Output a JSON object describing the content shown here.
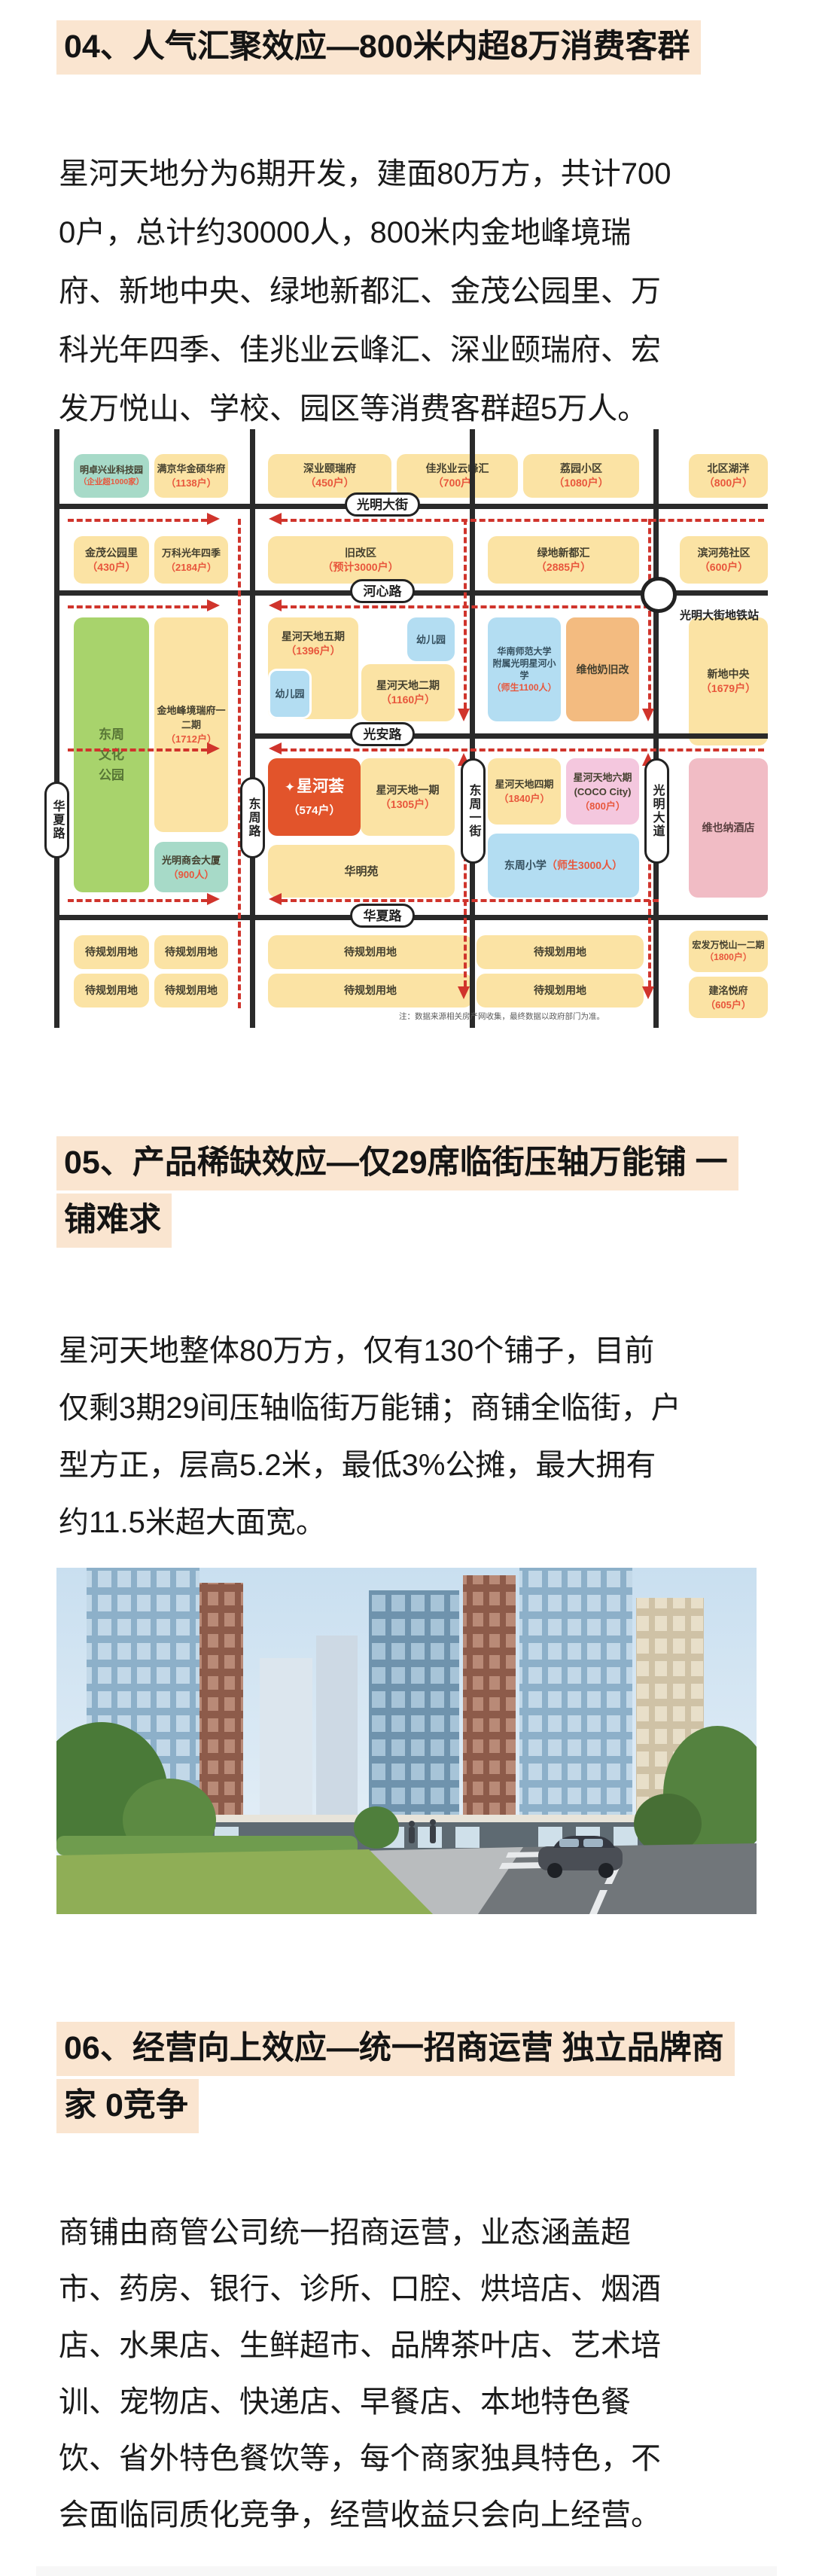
{
  "s04": {
    "heading": "04、人气汇聚效应—800米内超8万消费客群",
    "para": [
      "星河天地分为6期开发，建面80万方，共计700",
      "0户，总计约30000人，800米内金地峰境瑞",
      "府、新地中央、绿地新都汇、金茂公园里、万",
      "科光年四季、佳兆业云峰汇、深业颐瑞府、宏",
      "发万悦山、学校、园区等消费客群超5万人。"
    ]
  },
  "s05": {
    "heading_lines": [
      "05、产品稀缺效应—仅29席临街压轴万能铺 一",
      "铺难求"
    ],
    "para": [
      "星河天地整体80万方，仅有130个铺子，目前",
      "仅剩3期29间压轴临街万能铺；商铺全临街，户",
      "型方正，层高5.2米，最低3%公摊，最大拥有",
      "约11.5米超大面宽。"
    ]
  },
  "s06": {
    "heading_lines": [
      "06、经营向上效应—统一招商运营 独立品牌商",
      "家 0竞争"
    ],
    "para": [
      "商铺由商管公司统一招商运营，业态涵盖超",
      "市、药房、银行、诊所、口腔、烘培店、烟酒",
      "店、水果店、生鲜超市、品牌茶叶店、艺术培",
      "训、宠物店、快递店、早餐店、本地特色餐",
      "饮、省外特色餐饮等，每个商家独具特色，不",
      "会面临同质化竞争，经营收益只会向上经营。"
    ]
  },
  "map": {
    "roads": {
      "guangming_street": "光明大街",
      "hexin_road": "河心路",
      "guangan_road": "光安路",
      "huaxia_road_h": "华夏路",
      "huaxia_road_v": "华夏路",
      "dongzhou_road": "东周路",
      "dongzhou_first_street": "东周一街",
      "guangming_avenue": "光明大道"
    },
    "metro_station": "光明大街地铁站",
    "note": "注：数据来源相关房产网收集，最终数据以政府部门为准。",
    "logo_star": "✦",
    "blocks": {
      "mingzhuo": {
        "name": "明卓兴业科技园",
        "num": "（企业超1000家）"
      },
      "manjinghua": {
        "name": "满京华金硕华府",
        "num": "（1138户）"
      },
      "shenye": {
        "name": "深业颐瑞府",
        "num": "（450户）"
      },
      "jiazhaoye": {
        "name": "佳兆业云峰汇",
        "num": "（700户）"
      },
      "liyuan": {
        "name": "荔园小区",
        "num": "（1080户）"
      },
      "beiqu": {
        "name": "北区湖泮",
        "num": "（800户）"
      },
      "jinmao": {
        "name": "金茂公园里",
        "num": "（430户）"
      },
      "vanke": {
        "name": "万科光年四季",
        "num": "（2184户）"
      },
      "jiugai": {
        "name": "旧改区",
        "num": "（预计3000户）"
      },
      "lvdi": {
        "name": "绿地新都汇",
        "num": "（2885户）"
      },
      "binheyuan": {
        "name": "滨河苑社区",
        "num": "（600户）"
      },
      "park": {
        "l1": "东周",
        "l2": "文化",
        "l3": "公园"
      },
      "jindi": {
        "name": "金地峰境瑞府一二期",
        "num": "（1712户）"
      },
      "shanghui": {
        "name": "光明商会大厦",
        "num": "（900人）"
      },
      "wuqi": {
        "name": "星河天地五期",
        "num": "（1396户）"
      },
      "youeryuan": {
        "name": "幼儿园"
      },
      "erqi": {
        "name": "星河天地二期",
        "num": "（1160户）"
      },
      "huanan": {
        "name1": "华南师范大学",
        "name2": "附属光明星河小学",
        "num": "（师生1100人）"
      },
      "weitanai": {
        "name": "维他奶旧改"
      },
      "xindi": {
        "name": "新地中央",
        "num": "（1679户）"
      },
      "xinghehui": {
        "name": "星河荟",
        "num": "（574户）"
      },
      "yiqi": {
        "name": "星河天地一期",
        "num": "（1305户）"
      },
      "huaming": {
        "name": "华明苑"
      },
      "siqi": {
        "name": "星河天地四期",
        "num": "（1840户）"
      },
      "liuqi": {
        "name1": "星河天地六期",
        "name2": "(COCO City)",
        "num": "（800户）"
      },
      "dongzhouxx": {
        "name": "东周小学",
        "num": "（师生3000人）"
      },
      "vienna": {
        "name": "维也纳酒店"
      },
      "pending": {
        "name": "待规划用地"
      },
      "hongfa": {
        "name": "宏发万悦山一二期",
        "num": "（1800户）"
      },
      "jianming": {
        "name": "建洺悦府",
        "num": "（605户）"
      }
    }
  }
}
